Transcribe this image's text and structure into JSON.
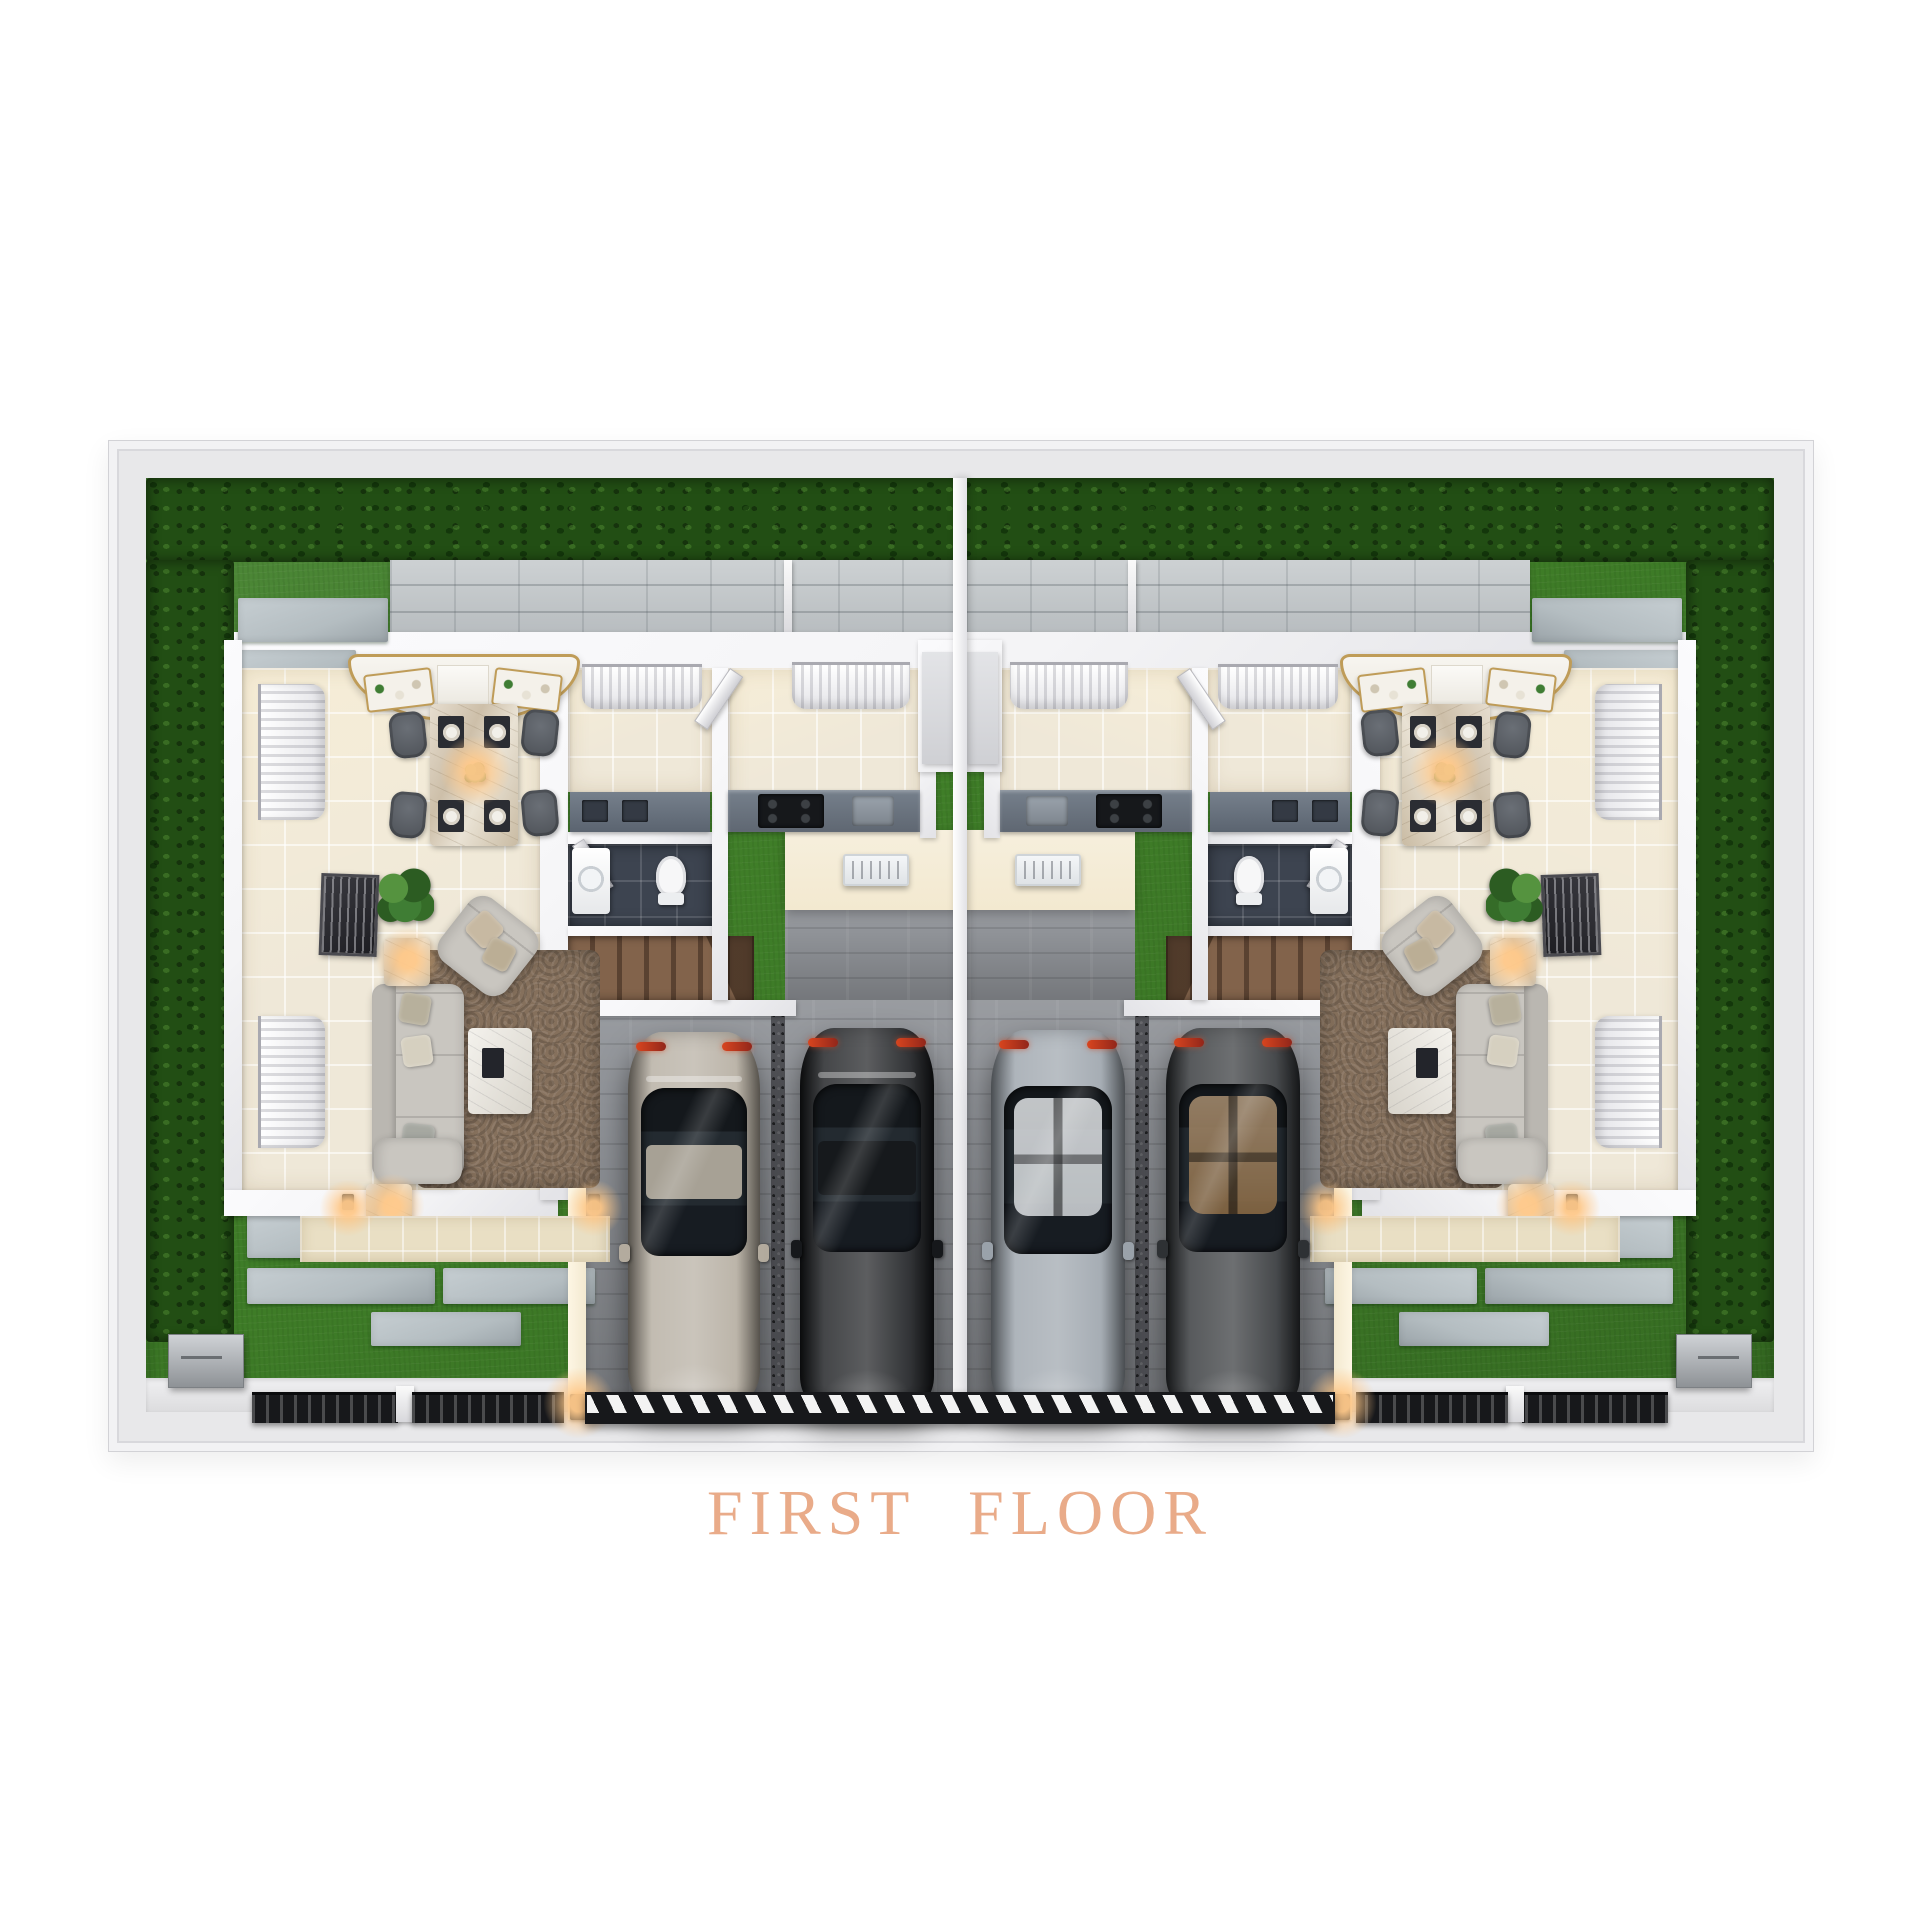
{
  "title": {
    "text": "FIRST FLOOR"
  },
  "colors": {
    "page_bg": "#ffffff",
    "title_text": "#e9ab89",
    "outer_wall": "#e8e8ea",
    "outer_wall_edge": "#d2d2d6",
    "grass": "#3f7e28",
    "grass_dark": "#2e641c",
    "hedge": "#224e14",
    "hedge_light": "#3a7a22",
    "block_wall": "#c0c4c6",
    "stone": "#b4bdc1",
    "house_wall": "#f4f4f6",
    "floor_cream": "#efe8d8",
    "floor_beige": "#e9dfc4",
    "bath_floor": "#3d4450",
    "counter": "#5f6772",
    "cabinet": "#6a7380",
    "wood": "#6e5440",
    "wood_light": "#82634b",
    "rug": "#85705c",
    "sofa": "#c9c6c0",
    "marble": "#d8cdbc",
    "gold": "#bf9c58",
    "driveway": "#8f9297",
    "drain": "#515257",
    "fence": "#17181b",
    "gate_stripe": "#f3f3f3",
    "cream_glow": "#f3e9d0",
    "lamp_glow": "#ffc98a",
    "curtain": "#f2f2f3",
    "plant": "#3f7d34"
  },
  "cars": [
    {
      "name": "car-silver-beige",
      "color": "#b3ab9e",
      "glass_roof": false
    },
    {
      "name": "car-black",
      "color": "#16181b",
      "glass_roof": false
    },
    {
      "name": "car-silver-gray",
      "color": "#9aa2aa",
      "glass_roof": true,
      "interior": "#cfd3d6"
    },
    {
      "name": "car-dark-charcoal",
      "color": "#2e3134",
      "glass_roof": true,
      "interior": "#8a6a45"
    }
  ],
  "scene": {
    "description": "3D top-down render of a mirrored duplex first floor with central shared driveway",
    "units": [
      {
        "label": "left-unit"
      },
      {
        "label": "right-unit"
      }
    ],
    "rooms": [
      "dining-area",
      "living-area",
      "kitchen",
      "utility-room",
      "bathroom",
      "staircase",
      "garage"
    ],
    "exterior": [
      "perimeter-hedge",
      "lawn",
      "stepping-stones",
      "paver-patio",
      "central-driveway",
      "front-fence",
      "driveway-gate",
      "storage-box"
    ]
  }
}
